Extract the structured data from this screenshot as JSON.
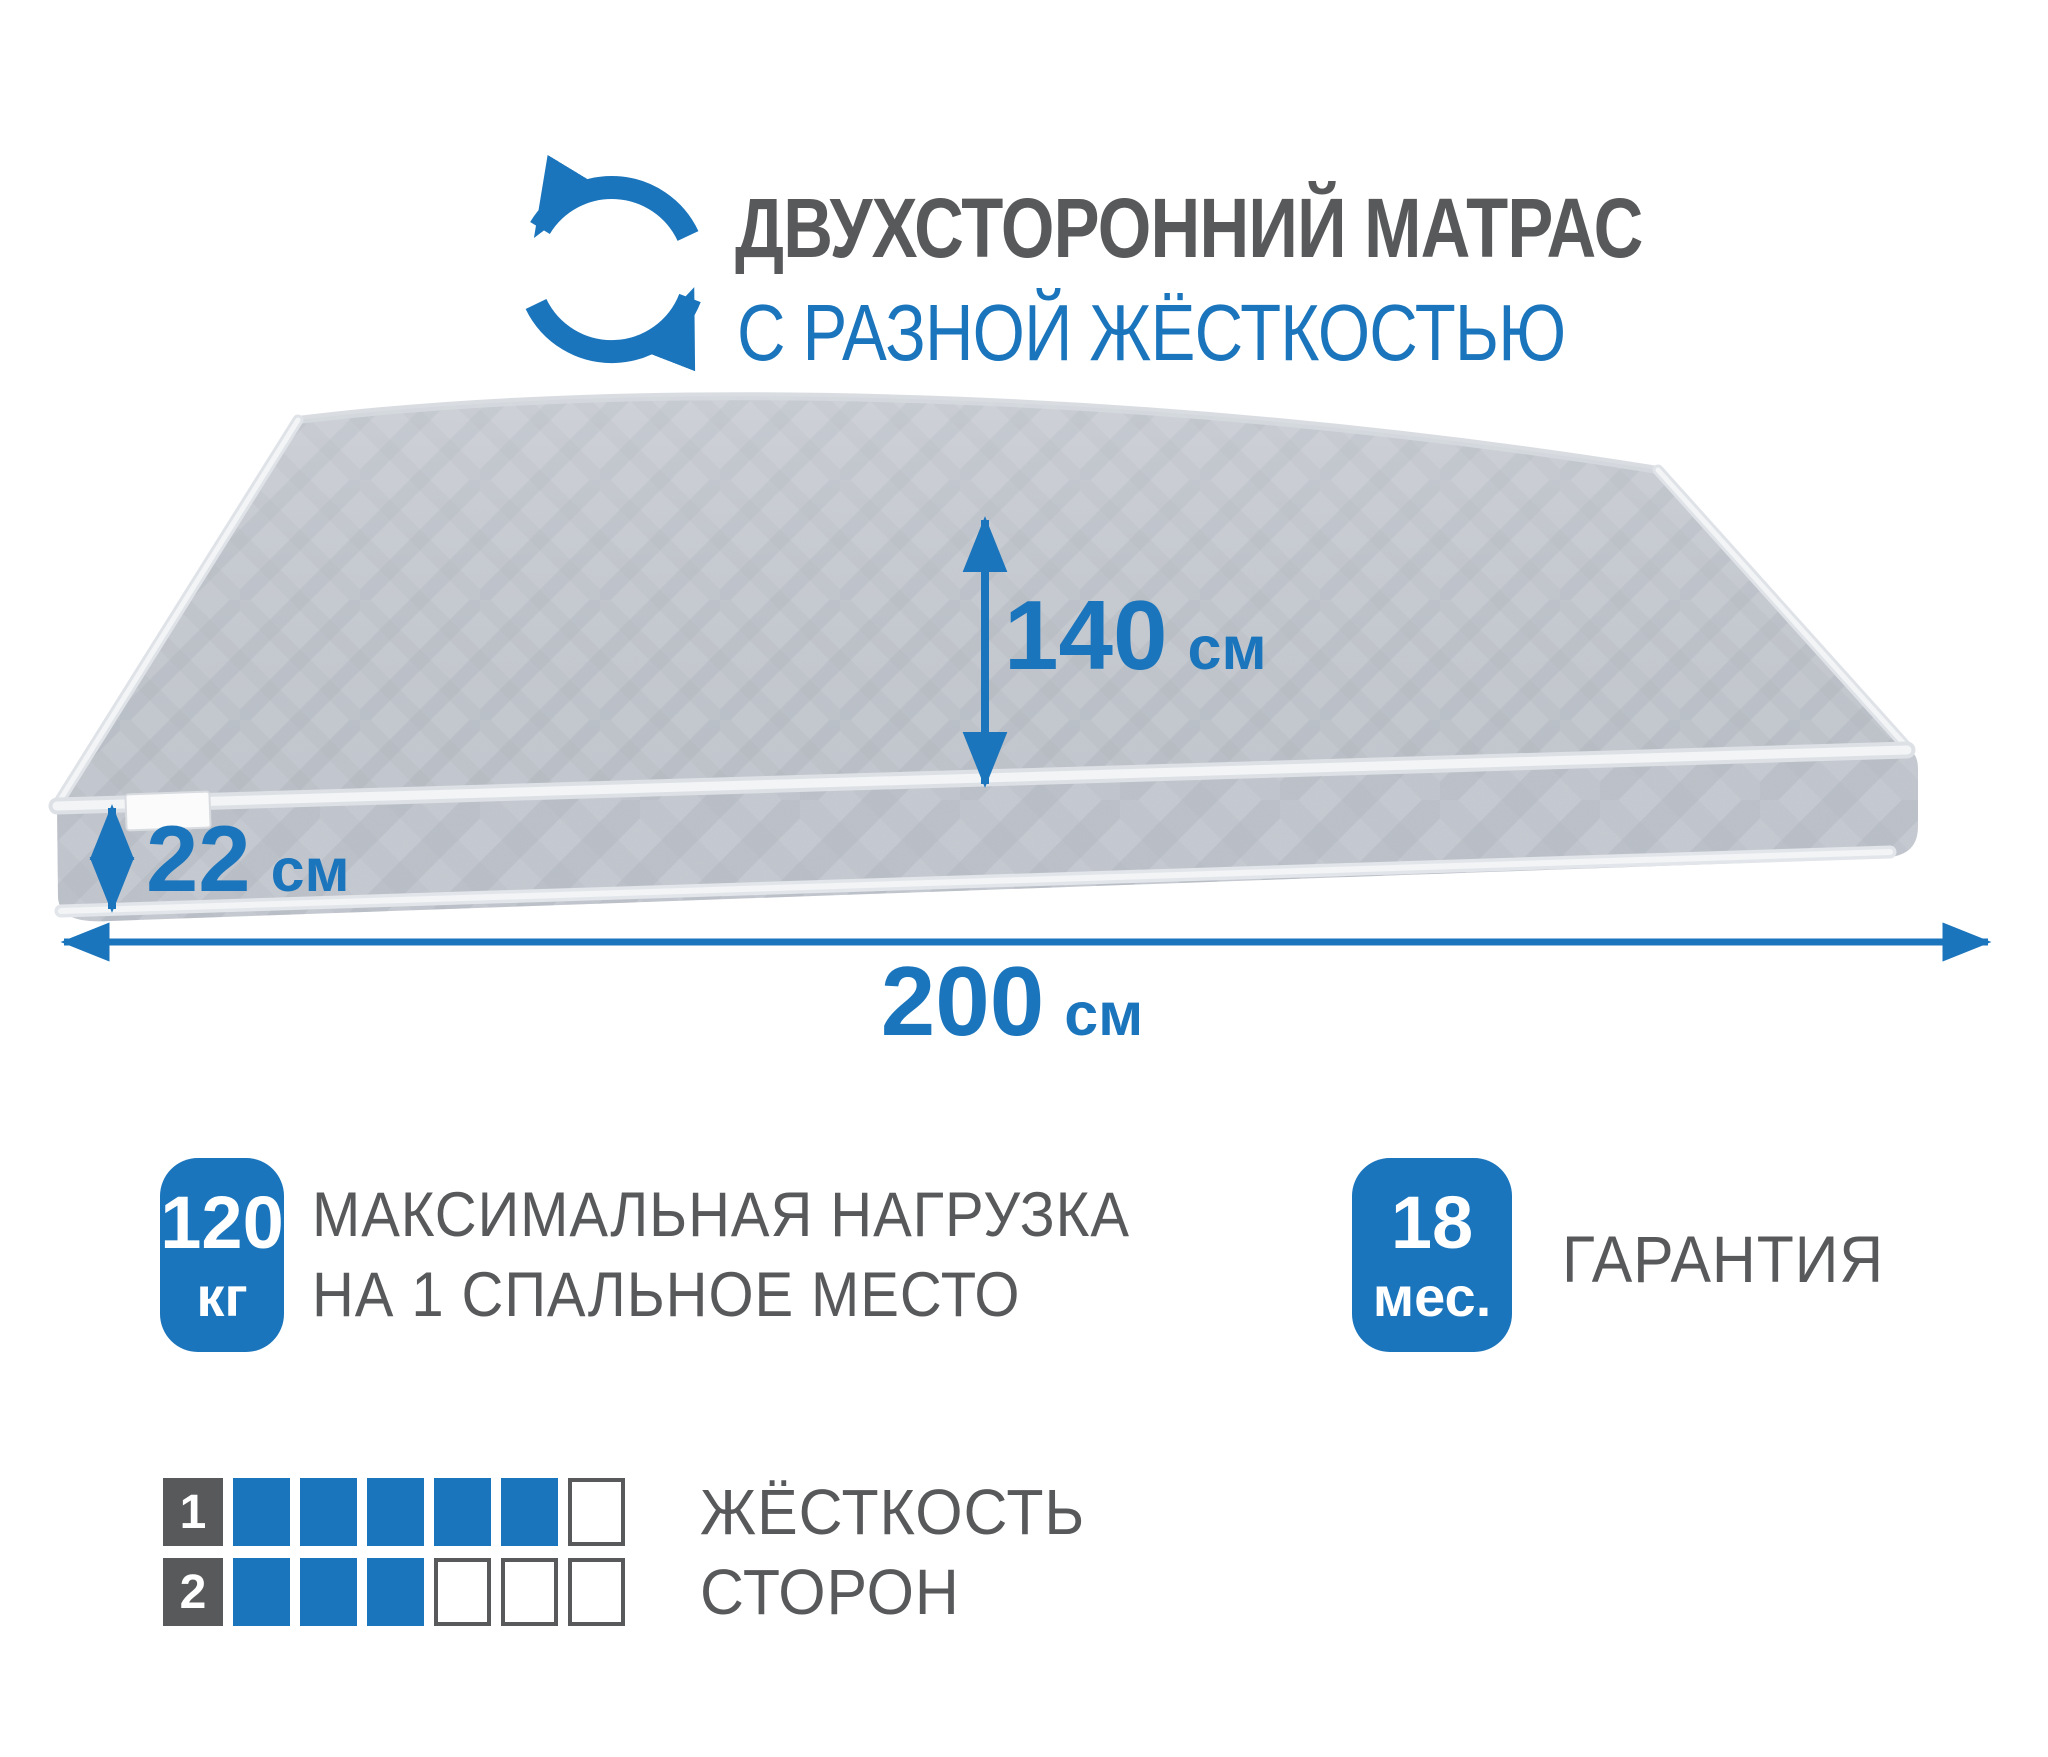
{
  "colors": {
    "accent_blue": "#1b75bc",
    "text_gray": "#58595b",
    "mattress_top": "#c6cad1",
    "mattress_side": "#c3c7ce",
    "piping": "#eef0f3"
  },
  "header": {
    "icon": "rotate-arrows-icon",
    "title": "ДВУХСТОРОННИЙ МАТРАС",
    "subtitle": "С РАЗНОЙ ЖЁСТКОСТЬЮ"
  },
  "dimensions": {
    "width": {
      "value": "140",
      "unit": "см"
    },
    "thickness": {
      "value": "22",
      "unit": "см"
    },
    "length": {
      "value": "200",
      "unit": "см"
    }
  },
  "max_load": {
    "badge_value": "120",
    "badge_unit": "кг",
    "line1": "МАКСИМАЛЬНАЯ НАГРУЗКА",
    "line2": "НА 1 СПАЛЬНОЕ МЕСТО"
  },
  "warranty": {
    "badge_value": "18",
    "badge_unit": "мес.",
    "label": "ГАРАНТИЯ"
  },
  "firmness": {
    "line1": "ЖЁСТКОСТЬ",
    "line2": "СТОРОН",
    "rows": [
      {
        "side": "1",
        "filled": 5,
        "total": 6
      },
      {
        "side": "2",
        "filled": 3,
        "total": 6
      }
    ]
  }
}
